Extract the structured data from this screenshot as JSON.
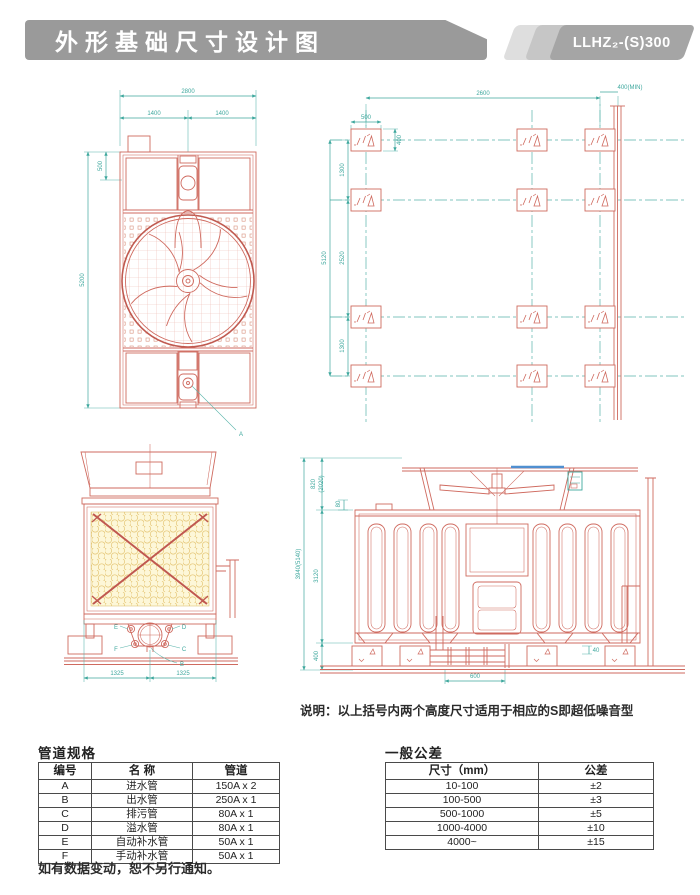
{
  "header": {
    "title": "外形基础尺寸设计图",
    "model": "LLHZ₂-(S)300"
  },
  "plan_view": {
    "dims": {
      "overall_width": "2800",
      "left_half": "1400",
      "right_half": "1400",
      "inlet_depth": "500",
      "overall_depth": "5200"
    },
    "marker_a": "A"
  },
  "foundation_plan": {
    "dims": {
      "width": "2600",
      "pad_width": "500",
      "pad_height": "400",
      "row_gap_top": "1300",
      "row_gap_middle": "2520",
      "row_gap_bottom": "1300",
      "total_depth": "5120",
      "side_clearance": "400(MIN)"
    }
  },
  "front_view": {
    "dims": {
      "left_span": "1325",
      "right_span": "1325"
    },
    "pipe_labels": {
      "e": "E",
      "d": "D",
      "f": "F",
      "c": "C",
      "b": "B"
    }
  },
  "side_view": {
    "dims": {
      "fan_height": "820",
      "fan_height_s": "(2020)",
      "deck_offset": "80",
      "body_height": "3120",
      "base_height": "400",
      "total_height": "3940(5140)",
      "pipe_offset": "600",
      "pad_offset": "40"
    }
  },
  "note": "说明：以上括号内两个高度尺寸适用于相应的S即超低噪音型",
  "pipe_table": {
    "title": "管道规格",
    "headers": [
      "编号",
      "名 称",
      "管道"
    ],
    "rows": [
      [
        "A",
        "进水管",
        "150A x 2"
      ],
      [
        "B",
        "出水管",
        "250A x 1"
      ],
      [
        "C",
        "排污管",
        "80A x 1"
      ],
      [
        "D",
        "溢水管",
        "80A x 1"
      ],
      [
        "E",
        "自动补水管",
        "50A x 1"
      ],
      [
        "F",
        "手动补水管",
        "50A x 1"
      ]
    ]
  },
  "tolerance_table": {
    "title": "一般公差",
    "headers": [
      "尺寸（mm）",
      "公差"
    ],
    "rows": [
      [
        "10-100",
        "±2"
      ],
      [
        "100-500",
        "±3"
      ],
      [
        "500-1000",
        "±5"
      ],
      [
        "1000-4000",
        "±10"
      ],
      [
        "4000~",
        "±15"
      ]
    ]
  },
  "footer_note": "如有数据变动，恕不另行通知。",
  "colors": {
    "drawing_red": "#cf6a5f",
    "dimension_teal": "#3fa89e",
    "fill_yellow": "#fdf5d6",
    "accent_blue": "#4f8fd0",
    "header_gray": "#9a9a9a"
  }
}
